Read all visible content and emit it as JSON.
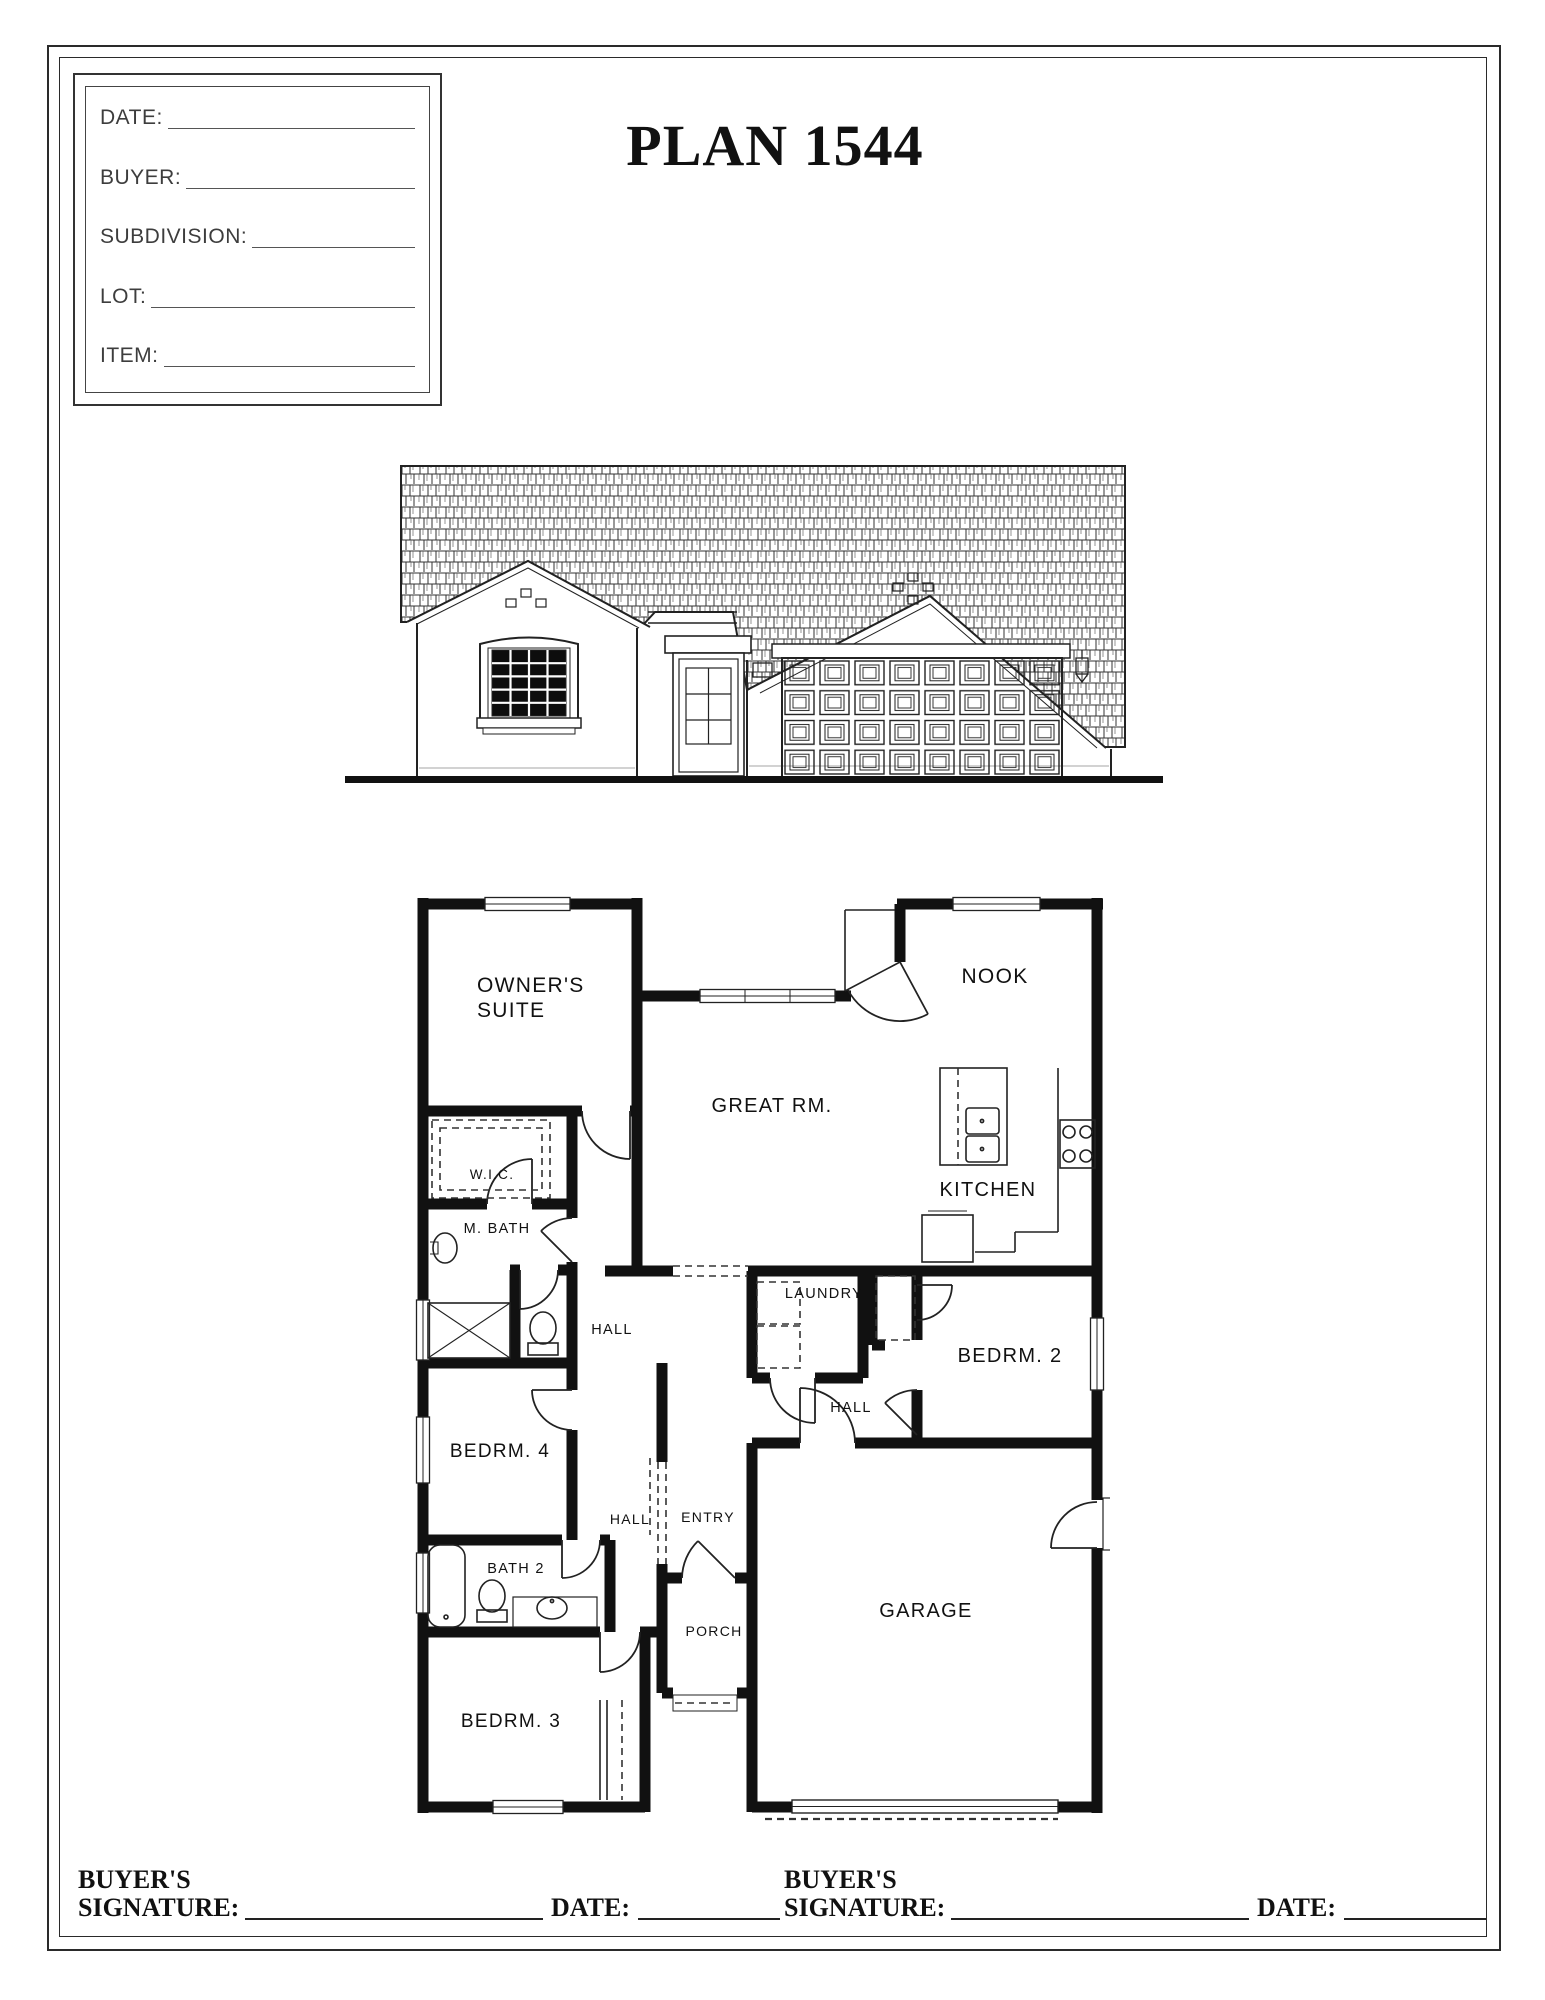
{
  "page": {
    "paper_color": "#ffffff",
    "ink_color": "#1a1a1a",
    "thin_line_color": "#444444"
  },
  "header": {
    "title": "PLAN 1544"
  },
  "order_form": {
    "fields": [
      {
        "label": "DATE:"
      },
      {
        "label": "BUYER:"
      },
      {
        "label": "SUBDIVISION:"
      },
      {
        "label": "LOT:"
      },
      {
        "label": "ITEM:"
      }
    ]
  },
  "floor_plan": {
    "rooms": {
      "owner_suite_1": "OWNER'S",
      "owner_suite_2": "SUITE",
      "nook": "NOOK",
      "great_rm": "GREAT RM.",
      "kitchen": "KITCHEN",
      "wic": "W.I.C.",
      "m_bath": "M. BATH",
      "hall_upper": "HALL",
      "laundry": "LAUNDRY",
      "bedrm2": "BEDRM. 2",
      "hall_mid": "HALL",
      "bedrm4": "BEDRM. 4",
      "hall_lower": "HALL",
      "entry": "ENTRY",
      "bath2": "BATH 2",
      "porch": "PORCH",
      "bedrm3": "BEDRM. 3",
      "garage": "GARAGE"
    }
  },
  "signature_row": {
    "buyers_label": "BUYER'S",
    "signature_label": "SIGNATURE:",
    "date_label": "DATE:"
  }
}
